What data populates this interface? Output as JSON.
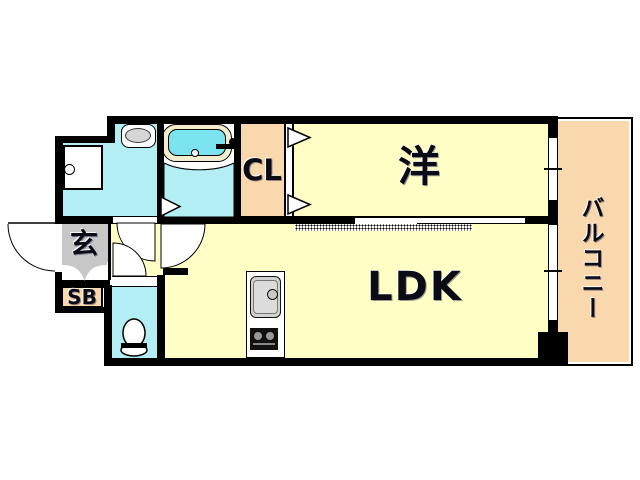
{
  "title": "apartment-floor-plan",
  "rooms": {
    "western": {
      "label": "洋"
    },
    "ldk": {
      "label": "LDK"
    },
    "closet": {
      "label": "CL"
    },
    "entrance": {
      "label": "玄"
    },
    "shoe_box": {
      "label": "SB"
    },
    "balcony": {
      "label": "バルコニー"
    }
  },
  "colors": {
    "room_yellow": "#FFFFC5",
    "balcony_peach": "#FAD8AE",
    "wet_area_cyan": "#B4EEF5",
    "bath_water": "#7CE3F0",
    "entrance_gray": "#C7C7C7",
    "fixture_gray": "#D6D6D6",
    "wall_black": "#000000"
  },
  "fixtures": [
    "bathtub-icon",
    "vanity-sink-icon",
    "washing-machine-icon",
    "toilet-icon",
    "kitchen-sink-icon",
    "stove-icon",
    "door-swing-icon",
    "folding-door-icon",
    "sliding-door-icon",
    "window-icon",
    "entrance-door-icon"
  ]
}
